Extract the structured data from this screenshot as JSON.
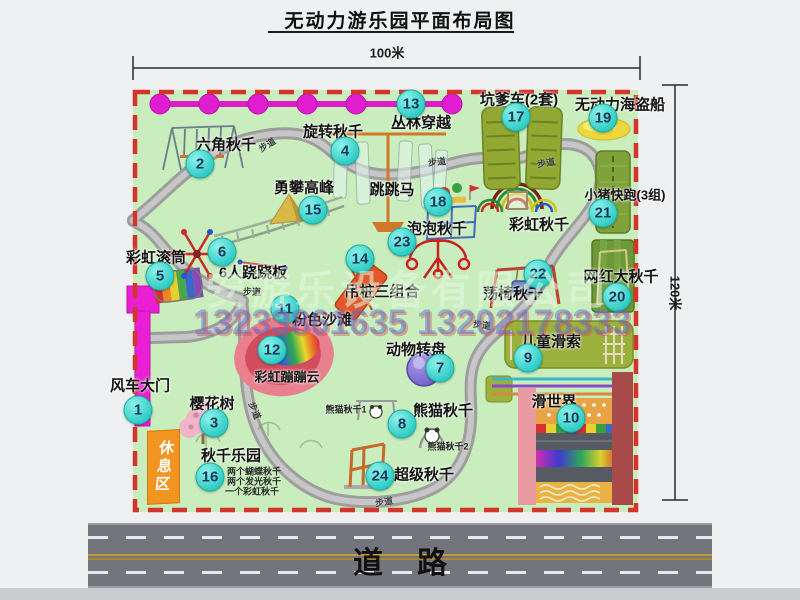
{
  "title": "无动力游乐园平面布局图",
  "dimensions": {
    "width_label": "100米",
    "height_label": "120米"
  },
  "road": {
    "label": "道路"
  },
  "rest_area": {
    "label": "休息区"
  },
  "walkway_label": "步道",
  "watermark": {
    "company": "安游乐设备有限公司",
    "phone": "13233861635 13202178333"
  },
  "colors": {
    "map_green": "#c9edbd",
    "border_red": "#d3352a",
    "badge_teal": "#2fccc6",
    "zipline_magenta": "#e01ed0",
    "gate_magenta": "#ea1ed2",
    "road_gray": "#74747c",
    "rest_orange": "#f29420"
  },
  "pois": [
    {
      "num": "1",
      "label": "风车大门"
    },
    {
      "num": "2",
      "label": "六角秋千"
    },
    {
      "num": "3",
      "label": "樱花树"
    },
    {
      "num": "4",
      "label": "旋转秋千"
    },
    {
      "num": "5",
      "label": "彩虹滚筒"
    },
    {
      "num": "6",
      "label": "6人跷跷板"
    },
    {
      "num": "7",
      "label": "动物转盘"
    },
    {
      "num": "8",
      "label": "熊猫秋千",
      "sub1": "熊猫秋千1",
      "sub2": "熊猫秋千2"
    },
    {
      "num": "9",
      "label": "儿童滑索"
    },
    {
      "num": "10",
      "label": "滑世界"
    },
    {
      "num": "11",
      "label": "粉色沙滩"
    },
    {
      "num": "12",
      "label": "彩虹蹦蹦云"
    },
    {
      "num": "13",
      "label": "丛林穿越"
    },
    {
      "num": "14",
      "label": "吊桩三组合"
    },
    {
      "num": "15",
      "label": "勇攀高峰"
    },
    {
      "num": "16",
      "label": "秋千乐园",
      "notes": [
        "两个蝴蝶秋千",
        "两个发光秋千",
        "一个彩虹秋千"
      ]
    },
    {
      "num": "17",
      "label": "坑爹车(2套)"
    },
    {
      "num": "18",
      "label": "跳跳马"
    },
    {
      "num": "19",
      "label": "无动力海盗船"
    },
    {
      "num": "20",
      "label": "网红大秋千"
    },
    {
      "num": "21",
      "label": "小猪快跑(3组)"
    },
    {
      "num": "22",
      "label": "荡椅秋千"
    },
    {
      "num": "23",
      "label": "泡泡秋千"
    },
    {
      "num": "24",
      "label": "超级秋千"
    },
    {
      "label": "彩虹秋千"
    }
  ]
}
